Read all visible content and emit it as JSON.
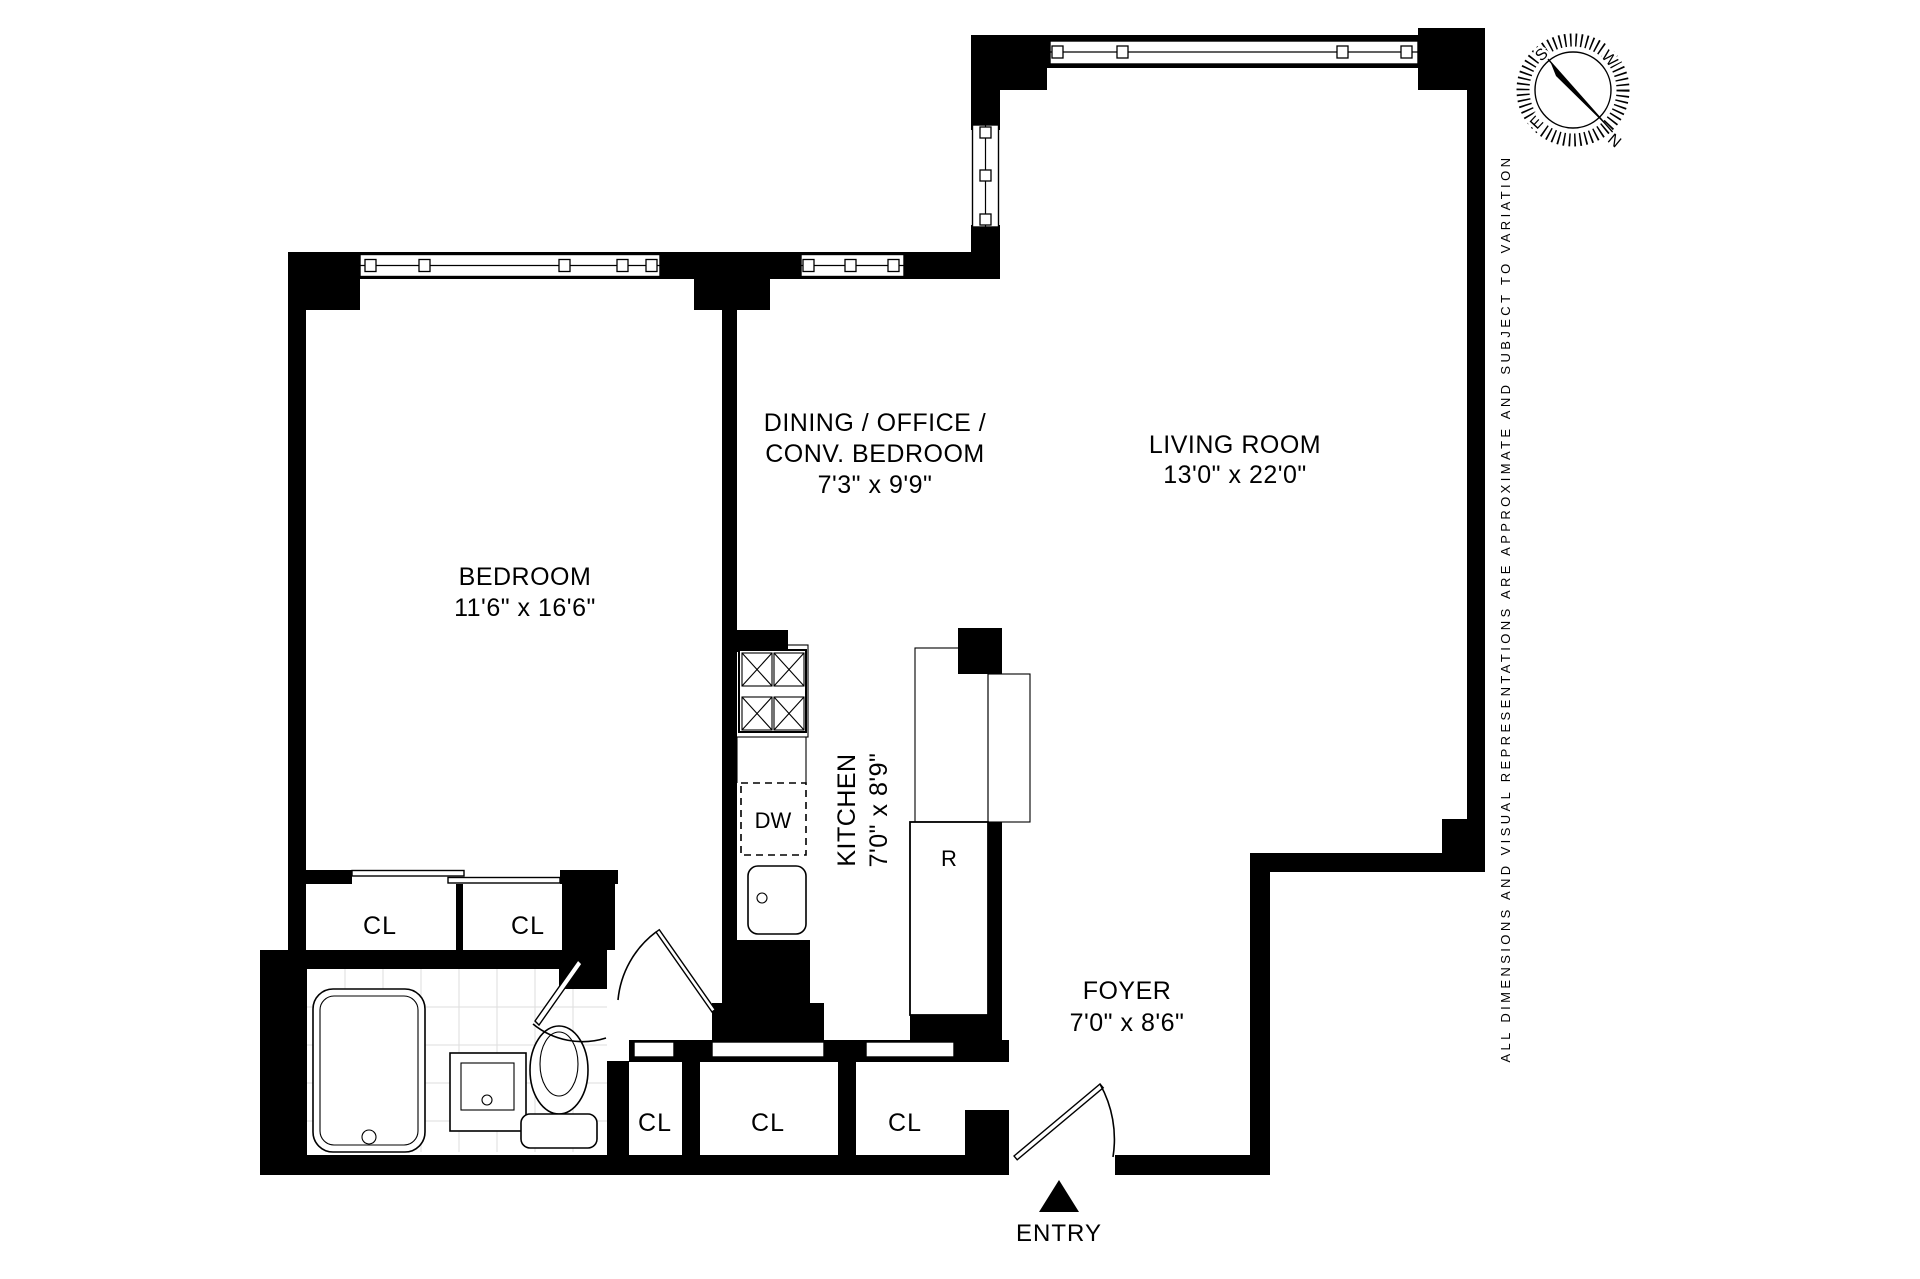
{
  "colors": {
    "wall": "#000000",
    "background": "#ffffff",
    "tile": "#dedede"
  },
  "rooms": {
    "bedroom": {
      "name": "BEDROOM",
      "dims": "11'6\" x 16'6\""
    },
    "dining": {
      "line1": "DINING / OFFICE /",
      "line2": "CONV. BEDROOM",
      "dims": "7'3\" x 9'9\""
    },
    "living": {
      "name": "LIVING ROOM",
      "dims": "13'0\" x 22'0\""
    },
    "kitchen": {
      "name": "KITCHEN",
      "dims": "7'0\" x 8'9\""
    },
    "foyer": {
      "name": "FOYER",
      "dims": "7'0\" x 8'6\""
    }
  },
  "labels": {
    "closet": "CL",
    "dishwasher": "DW",
    "refrigerator": "R",
    "entry": "ENTRY"
  },
  "compass": {
    "north": "N",
    "south": "S",
    "east": "E",
    "west": "W"
  },
  "disclaimer": "ALL DIMENSIONS AND VISUAL REPRESENTATIONS ARE APPROXIMATE AND SUBJECT TO VARIATION"
}
